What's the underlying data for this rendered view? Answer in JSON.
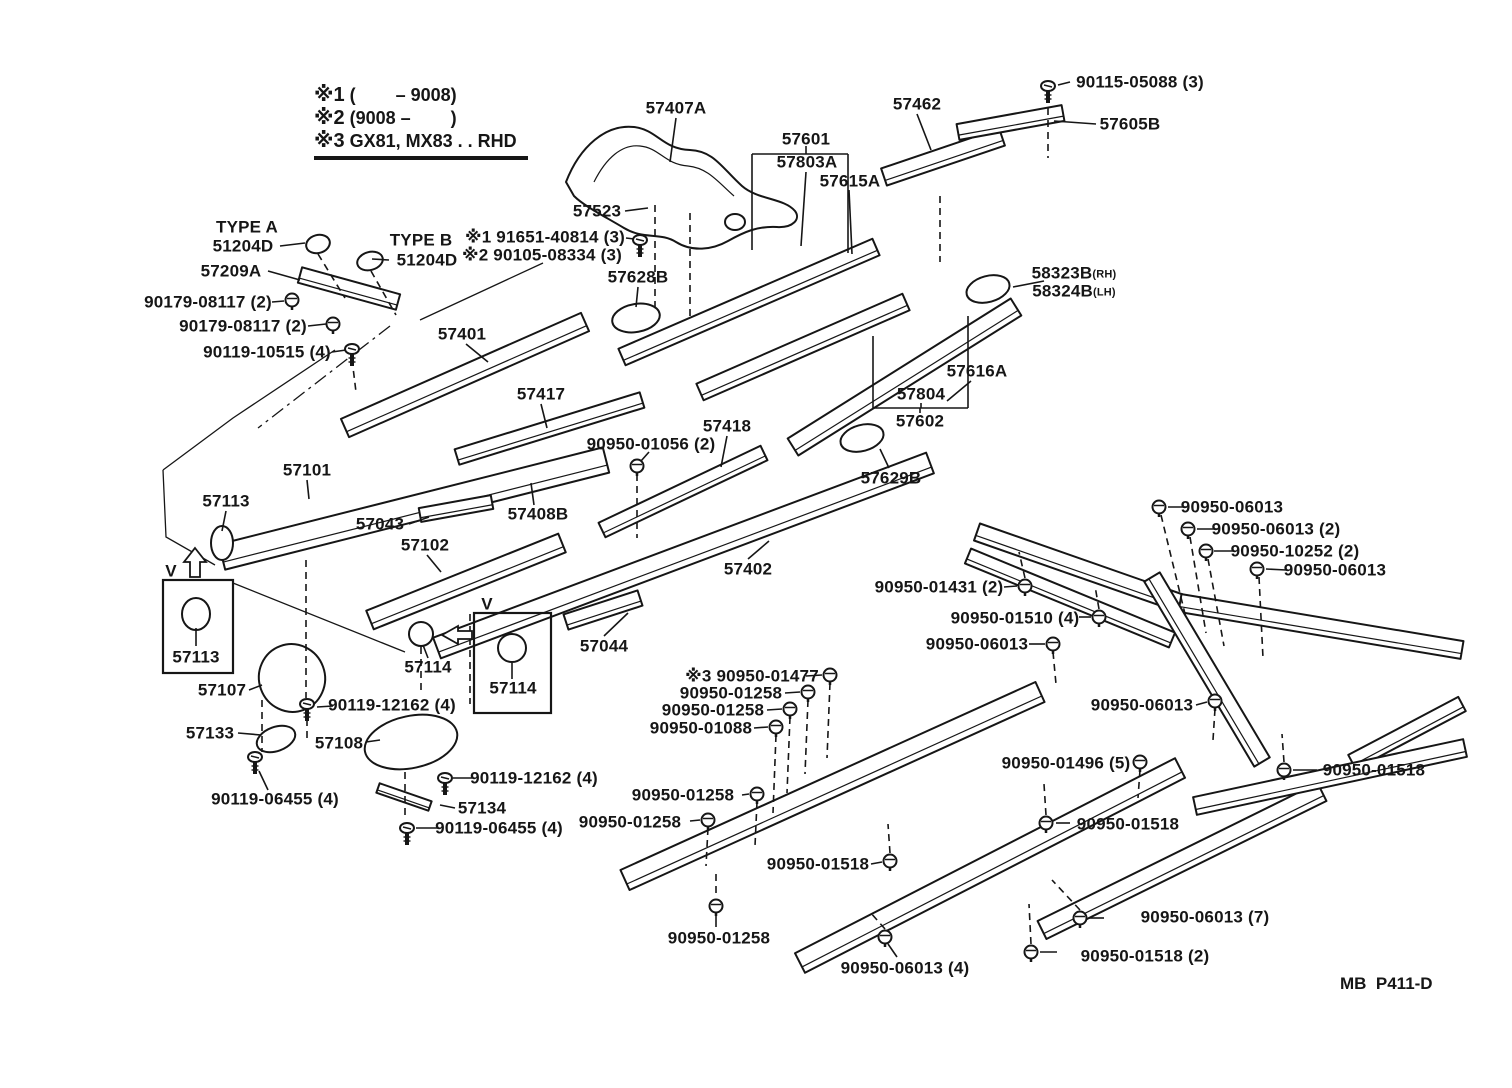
{
  "colors": {
    "ink": "#161616",
    "paper": "#ffffff"
  },
  "diagram": {
    "page_code": "MB  P411-D",
    "notes": [
      {
        "marker": "※1",
        "text": "(        – 9008)"
      },
      {
        "marker": "※2",
        "text": "(9008 –        )"
      },
      {
        "marker": "※3",
        "text": "GX81, MX83 . . RHD"
      }
    ],
    "labels": [
      {
        "text": "57407A",
        "x": 676,
        "y": 108
      },
      {
        "text": "57601",
        "x": 806,
        "y": 139
      },
      {
        "text": "57803A",
        "x": 807,
        "y": 162
      },
      {
        "text": "57615A",
        "x": 850,
        "y": 181
      },
      {
        "text": "57462",
        "x": 917,
        "y": 104
      },
      {
        "text": "90115-05088 (3)",
        "x": 1140,
        "y": 82
      },
      {
        "text": "57605B",
        "x": 1130,
        "y": 124
      },
      {
        "text": "TYPE A",
        "x": 247,
        "y": 227
      },
      {
        "text": "51204D",
        "x": 243,
        "y": 246
      },
      {
        "text": "TYPE B",
        "x": 421,
        "y": 240
      },
      {
        "text": "51204D",
        "x": 427,
        "y": 260
      },
      {
        "text": "57209A",
        "x": 231,
        "y": 271
      },
      {
        "text": "90179-08117 (2)",
        "x": 208,
        "y": 302
      },
      {
        "text": "90179-08117 (2)",
        "x": 243,
        "y": 326
      },
      {
        "text": "90119-10515 (4)",
        "x": 267,
        "y": 352
      },
      {
        "text": "57523",
        "x": 597,
        "y": 211
      },
      {
        "text": "※1 91651-40814 (3)",
        "x": 545,
        "y": 237
      },
      {
        "text": "※2 90105-08334 (3)",
        "x": 542,
        "y": 255
      },
      {
        "text": "57628B",
        "x": 638,
        "y": 277
      },
      {
        "text": "58323B",
        "x": 1074,
        "y": 273,
        "suffix": "(RH)"
      },
      {
        "text": "58324B",
        "x": 1074,
        "y": 291,
        "suffix": "(LH)"
      },
      {
        "text": "57401",
        "x": 462,
        "y": 334
      },
      {
        "text": "57417",
        "x": 541,
        "y": 394
      },
      {
        "text": "57418",
        "x": 727,
        "y": 426
      },
      {
        "text": "90950-01056 (2)",
        "x": 651,
        "y": 444
      },
      {
        "text": "57616A",
        "x": 977,
        "y": 371
      },
      {
        "text": "57804",
        "x": 921,
        "y": 394
      },
      {
        "text": "57602",
        "x": 920,
        "y": 421
      },
      {
        "text": "57629B",
        "x": 891,
        "y": 478
      },
      {
        "text": "57101",
        "x": 307,
        "y": 470
      },
      {
        "text": "57113",
        "x": 226,
        "y": 501
      },
      {
        "text": "57043",
        "x": 380,
        "y": 524
      },
      {
        "text": "57102",
        "x": 425,
        "y": 545
      },
      {
        "text": "57408B",
        "x": 538,
        "y": 514
      },
      {
        "text": "57402",
        "x": 748,
        "y": 569
      },
      {
        "text": "90950-06013",
        "x": 1232,
        "y": 507
      },
      {
        "text": "90950-06013 (2)",
        "x": 1276,
        "y": 529
      },
      {
        "text": "90950-10252 (2)",
        "x": 1295,
        "y": 551
      },
      {
        "text": "90950-06013",
        "x": 1335,
        "y": 570
      },
      {
        "text": "90950-01431 (2)",
        "x": 939,
        "y": 587
      },
      {
        "text": "90950-01510 (4)",
        "x": 1015,
        "y": 618
      },
      {
        "text": "90950-06013",
        "x": 977,
        "y": 644
      },
      {
        "text": "V",
        "x": 171,
        "y": 571
      },
      {
        "text": "57113",
        "x": 196,
        "y": 657
      },
      {
        "text": "57107",
        "x": 222,
        "y": 690
      },
      {
        "text": "57114",
        "x": 428,
        "y": 667
      },
      {
        "text": "V",
        "x": 487,
        "y": 604
      },
      {
        "text": "57114",
        "x": 513,
        "y": 688
      },
      {
        "text": "57044",
        "x": 604,
        "y": 646
      },
      {
        "text": "※3 90950-01477",
        "x": 752,
        "y": 676
      },
      {
        "text": "90950-01258",
        "x": 731,
        "y": 693
      },
      {
        "text": "90950-01258",
        "x": 713,
        "y": 710
      },
      {
        "text": "90950-01088",
        "x": 701,
        "y": 728
      },
      {
        "text": "90119-12162 (4)",
        "x": 392,
        "y": 705
      },
      {
        "text": "57133",
        "x": 210,
        "y": 733
      },
      {
        "text": "57108",
        "x": 339,
        "y": 743
      },
      {
        "text": "90119-12162 (4)",
        "x": 534,
        "y": 778
      },
      {
        "text": "90119-06455 (4)",
        "x": 275,
        "y": 799
      },
      {
        "text": "57134",
        "x": 482,
        "y": 808
      },
      {
        "text": "90119-06455 (4)",
        "x": 499,
        "y": 828
      },
      {
        "text": "90950-01258",
        "x": 683,
        "y": 795
      },
      {
        "text": "90950-01258",
        "x": 630,
        "y": 822
      },
      {
        "text": "90950-01518",
        "x": 818,
        "y": 864
      },
      {
        "text": "90950-01496 (5)",
        "x": 1066,
        "y": 763
      },
      {
        "text": "90950-01518",
        "x": 1128,
        "y": 824
      },
      {
        "text": "90950-06013",
        "x": 1142,
        "y": 705
      },
      {
        "text": "90950-01518",
        "x": 1374,
        "y": 770
      },
      {
        "text": "90950-01258",
        "x": 719,
        "y": 938
      },
      {
        "text": "90950-06013 (4)",
        "x": 905,
        "y": 968
      },
      {
        "text": "90950-01518 (2)",
        "x": 1145,
        "y": 956
      },
      {
        "text": "90950-06013 (7)",
        "x": 1205,
        "y": 917
      }
    ]
  }
}
